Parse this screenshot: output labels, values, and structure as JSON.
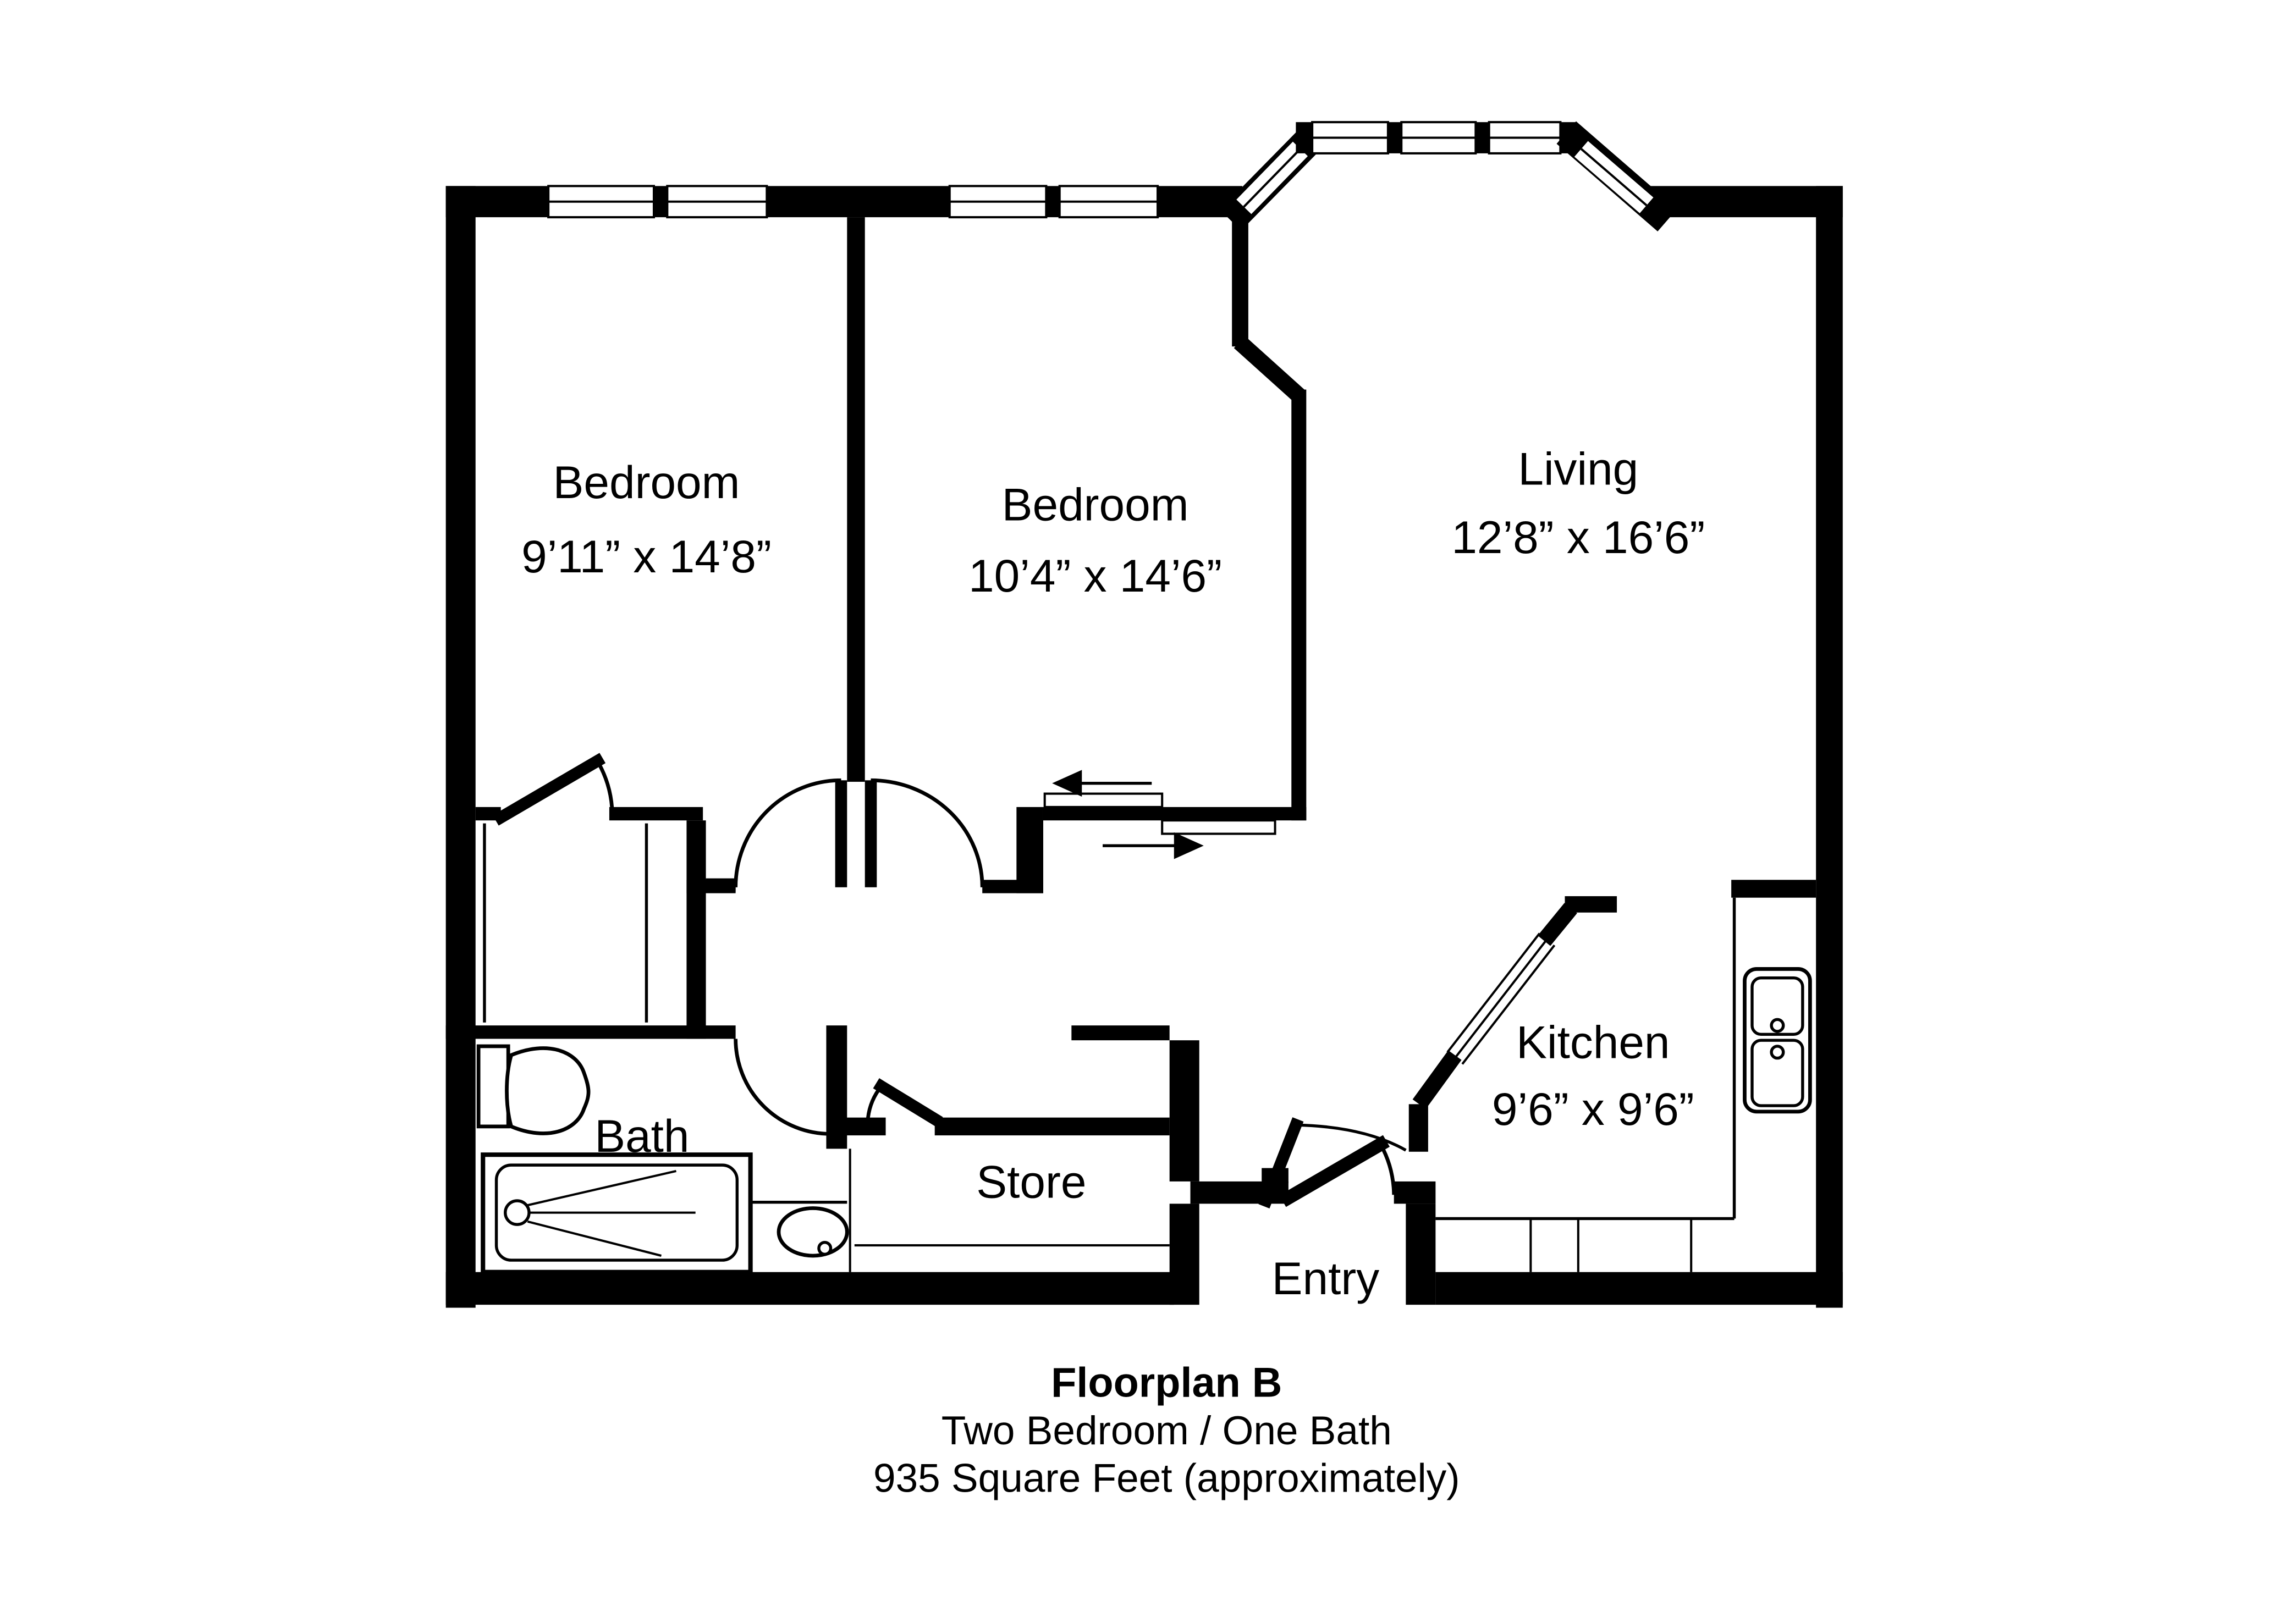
{
  "plan": {
    "rooms": [
      {
        "id": "bedroom-1",
        "name": "Bedroom",
        "dims": "9’11” x 14’8”"
      },
      {
        "id": "bedroom-2",
        "name": "Bedroom",
        "dims": "10’4” x 14’6”"
      },
      {
        "id": "living",
        "name": "Living",
        "dims": "12’8” x 16’6”"
      },
      {
        "id": "kitchen",
        "name": "Kitchen",
        "dims": "9’6” x 9’6”"
      },
      {
        "id": "bath",
        "name": "Bath",
        "dims": ""
      },
      {
        "id": "store",
        "name": "Store",
        "dims": ""
      },
      {
        "id": "entry",
        "name": "Entry",
        "dims": ""
      }
    ],
    "caption": {
      "title": "Floorplan B",
      "subtitle": "Two Bedroom / One Bath",
      "area": "935 Square Feet (approximately)"
    },
    "fixtures": [
      "toilet-icon",
      "shower-icon",
      "bath-sink-icon",
      "kitchen-sink-icon",
      "slide-left-arrow-icon",
      "slide-right-arrow-icon"
    ],
    "colors": {
      "wall": "#000000",
      "background": "#ffffff",
      "line": "#000000"
    }
  }
}
